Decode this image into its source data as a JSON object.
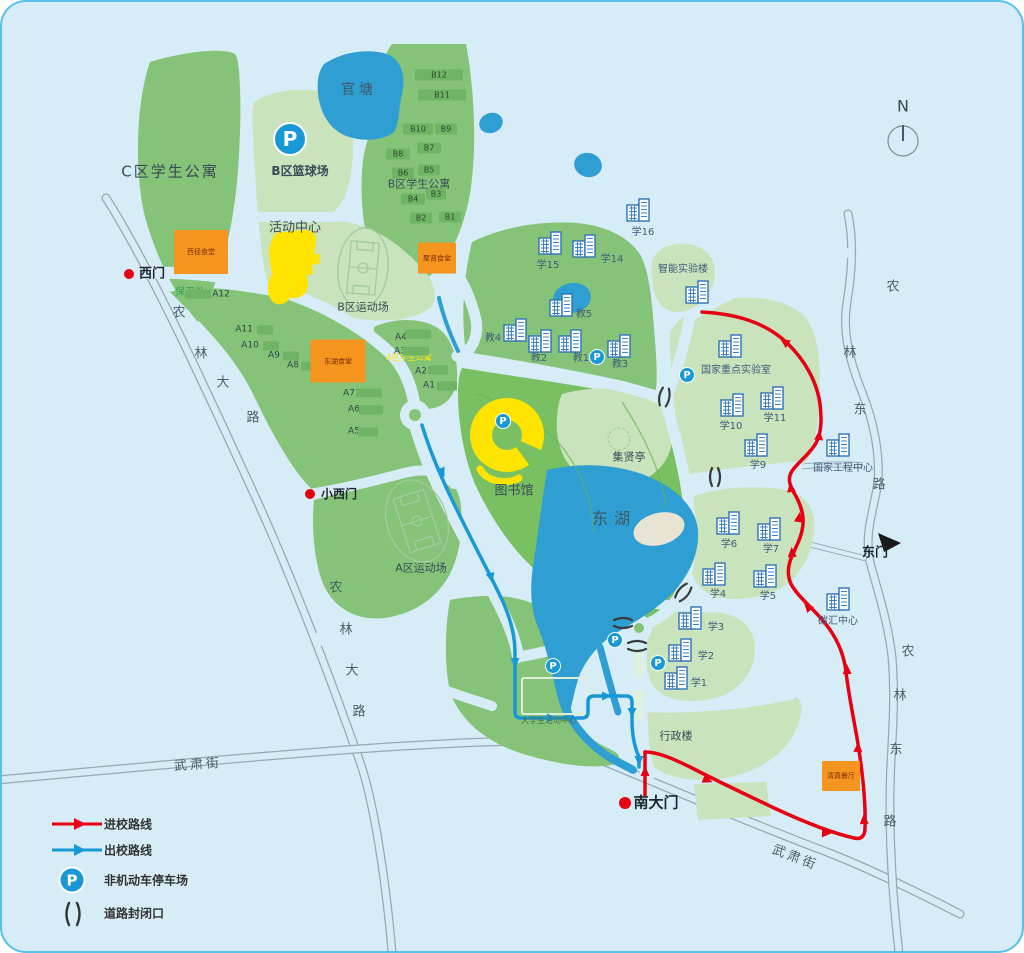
{
  "title": "校园导览图",
  "colors": {
    "background": "#d6edf7",
    "water": "#2e9ed3",
    "green_mid": "#85c478",
    "green_pale": "#c9e3bc",
    "green_park": "#79c062",
    "route_in": "#e60012",
    "route_out": "#1899d6",
    "parking_blue": "#1899d6",
    "building_icon": "#2d73b8",
    "canteen_orange": "#f5941e",
    "highlight_yellow": "#ffe400"
  },
  "icons": {
    "parking_glyph": "P"
  },
  "compass": {
    "label": "N"
  },
  "legend": {
    "items": [
      {
        "label": "进校路线"
      },
      {
        "label": "出校路线"
      },
      {
        "label": "非机动车停车场"
      },
      {
        "label": "道路封闭口"
      }
    ]
  },
  "map": {
    "area_labels": [
      {
        "name": "c-district-apartments",
        "text": "C区学生公寓",
        "x": 168,
        "y": 170,
        "size": 15,
        "ls": 2
      },
      {
        "name": "b-basketball-court",
        "text": "B区篮球场",
        "x": 298,
        "y": 169,
        "size": 12,
        "bold": true
      },
      {
        "name": "b-district-apartments",
        "text": "B区学生公寓",
        "x": 417,
        "y": 182,
        "size": 11
      },
      {
        "name": "activity-center",
        "text": "活动中心",
        "x": 293,
        "y": 226,
        "size": 13
      },
      {
        "name": "b-sports-field",
        "text": "B区运动场",
        "x": 361,
        "y": 305,
        "size": 11
      },
      {
        "name": "a-sports-field",
        "text": "A区运动场",
        "x": 419,
        "y": 566,
        "size": 11
      },
      {
        "name": "guantang-pond",
        "text": "官塘",
        "x": 357,
        "y": 88,
        "size": 14,
        "ls": 4,
        "color": "#3f5866"
      },
      {
        "name": "east-lake",
        "text": "东湖",
        "x": 612,
        "y": 517,
        "size": 16,
        "ls": 6,
        "color": "#3d5a66"
      },
      {
        "name": "library",
        "text": "图书馆",
        "x": 512,
        "y": 489,
        "size": 13
      },
      {
        "name": "jixian-pavilion",
        "text": "集贤亭",
        "x": 627,
        "y": 455,
        "size": 11
      },
      {
        "name": "security-office",
        "text": "保卫处",
        "x": 188,
        "y": 291,
        "size": 10,
        "color": "#2fa05c"
      },
      {
        "name": "a-district-apartments",
        "text": "A区学生公寓",
        "x": 407,
        "y": 356,
        "size": 8,
        "color": "#ffe400"
      },
      {
        "name": "student-activity-center",
        "text": "大学生活动中心",
        "x": 547,
        "y": 719,
        "size": 8,
        "color": "#4a6b46"
      },
      {
        "name": "admin-building",
        "text": "行政楼",
        "x": 674,
        "y": 734,
        "size": 11
      }
    ],
    "building_labels": [
      {
        "text": "学16",
        "lx": 641,
        "ly": 231,
        "ix": 637,
        "iy": 208
      },
      {
        "text": "学15",
        "lx": 546,
        "ly": 264,
        "ix": 549,
        "iy": 241
      },
      {
        "text": "学14",
        "lx": 610,
        "ly": 258,
        "ix": 583,
        "iy": 244
      },
      {
        "text": "智能实验楼",
        "lx": 681,
        "ly": 268,
        "ix": 696,
        "iy": 290
      },
      {
        "text": "教5",
        "lx": 582,
        "ly": 313,
        "ix": 560,
        "iy": 303
      },
      {
        "text": "教4",
        "lx": 491,
        "ly": 337,
        "ix": 514,
        "iy": 328
      },
      {
        "text": "教2",
        "lx": 537,
        "ly": 357,
        "ix": 539,
        "iy": 339
      },
      {
        "text": "教1",
        "lx": 579,
        "ly": 357,
        "ix": 569,
        "iy": 339
      },
      {
        "text": "教3",
        "lx": 618,
        "ly": 363,
        "ix": 618,
        "iy": 344
      },
      {
        "text": "国家重点实验室",
        "lx": 734,
        "ly": 369,
        "ix": 729,
        "iy": 344
      },
      {
        "text": "学10",
        "lx": 729,
        "ly": 425,
        "ix": 731,
        "iy": 403
      },
      {
        "text": "学11",
        "lx": 773,
        "ly": 417,
        "ix": 771,
        "iy": 396
      },
      {
        "text": "学9",
        "lx": 756,
        "ly": 464,
        "ix": 755,
        "iy": 443
      },
      {
        "text": "国家工程中心",
        "lx": 841,
        "ly": 467,
        "ix": 837,
        "iy": 443
      },
      {
        "text": "学6",
        "lx": 727,
        "ly": 543,
        "ix": 727,
        "iy": 521
      },
      {
        "text": "学7",
        "lx": 769,
        "ly": 548,
        "ix": 768,
        "iy": 527
      },
      {
        "text": "学4",
        "lx": 716,
        "ly": 593,
        "ix": 713,
        "iy": 572
      },
      {
        "text": "学5",
        "lx": 766,
        "ly": 595,
        "ix": 764,
        "iy": 574
      },
      {
        "text": "学3",
        "lx": 714,
        "ly": 626,
        "ix": 689,
        "iy": 616
      },
      {
        "text": "学2",
        "lx": 704,
        "ly": 655,
        "ix": 679,
        "iy": 648
      },
      {
        "text": "学1",
        "lx": 697,
        "ly": 682,
        "ix": 675,
        "iy": 676
      },
      {
        "text": "碳汇中心",
        "lx": 836,
        "ly": 620,
        "ix": 837,
        "iy": 597
      }
    ],
    "dorm_blocks": [
      {
        "text": "B12",
        "x": 437,
        "y": 73,
        "w": 48
      },
      {
        "text": "B11",
        "x": 440,
        "y": 93,
        "w": 48
      },
      {
        "text": "B10",
        "x": 416,
        "y": 127,
        "w": 30
      },
      {
        "text": "B9",
        "x": 444,
        "y": 127,
        "w": 22
      },
      {
        "text": "B8",
        "x": 396,
        "y": 152,
        "w": 24
      },
      {
        "text": "B7",
        "x": 427,
        "y": 146,
        "w": 24
      },
      {
        "text": "B6",
        "x": 401,
        "y": 171,
        "w": 22
      },
      {
        "text": "B5",
        "x": 427,
        "y": 168,
        "w": 22
      },
      {
        "text": "B4",
        "x": 411,
        "y": 197,
        "w": 24
      },
      {
        "text": "B3",
        "x": 434,
        "y": 192,
        "w": 20
      },
      {
        "text": "B2",
        "x": 419,
        "y": 216,
        "w": 22
      },
      {
        "text": "B1",
        "x": 448,
        "y": 215,
        "w": 22
      }
    ],
    "dorm_labels": [
      {
        "text": "A12",
        "x": 219,
        "y": 293
      },
      {
        "text": "A11",
        "x": 242,
        "y": 328
      },
      {
        "text": "A10",
        "x": 248,
        "y": 344
      },
      {
        "text": "A9",
        "x": 272,
        "y": 354
      },
      {
        "text": "A8",
        "x": 291,
        "y": 364
      },
      {
        "text": "A7",
        "x": 347,
        "y": 392
      },
      {
        "text": "A6",
        "x": 352,
        "y": 408
      },
      {
        "text": "A5",
        "x": 352,
        "y": 430
      },
      {
        "text": "A4",
        "x": 399,
        "y": 336
      },
      {
        "text": "A3",
        "x": 398,
        "y": 350
      },
      {
        "text": "A2",
        "x": 419,
        "y": 370
      },
      {
        "text": "A1",
        "x": 427,
        "y": 384
      }
    ],
    "bars": [
      [
        196,
        292,
        26
      ],
      [
        263,
        328,
        16
      ],
      [
        269,
        344,
        16
      ],
      [
        289,
        354,
        16
      ],
      [
        307,
        364,
        16
      ],
      [
        367,
        391,
        26
      ],
      [
        369,
        408,
        24
      ],
      [
        366,
        430,
        20
      ],
      [
        416,
        332,
        26
      ],
      [
        414,
        349,
        26
      ],
      [
        436,
        368,
        20
      ],
      [
        445,
        384,
        20
      ]
    ],
    "canteens": [
      {
        "text": "西径食堂",
        "x": 199,
        "y": 250,
        "w": 54,
        "h": 44
      },
      {
        "text": "东湖食堂",
        "x": 336,
        "y": 359,
        "w": 55,
        "h": 43
      },
      {
        "text": "聚贤食堂",
        "x": 435,
        "y": 256,
        "w": 38,
        "h": 31
      },
      {
        "text": "清真餐厅",
        "x": 839,
        "y": 774,
        "w": 38,
        "h": 30
      }
    ],
    "gates": [
      {
        "text": "西门",
        "x": 150,
        "y": 272,
        "dot": [
          127,
          272
        ],
        "size": 13
      },
      {
        "text": "小西门",
        "x": 337,
        "y": 492,
        "dot": [
          308,
          492
        ],
        "size": 12
      },
      {
        "text": "南大门",
        "x": 654,
        "y": 801,
        "dot": [
          623,
          801
        ],
        "size": 15
      },
      {
        "text": "东门",
        "x": 873,
        "y": 551,
        "size": 13
      }
    ],
    "road_chars": [
      {
        "text": "农",
        "x": 177,
        "y": 311
      },
      {
        "text": "林",
        "x": 199,
        "y": 352
      },
      {
        "text": "大",
        "x": 221,
        "y": 381
      },
      {
        "text": "路",
        "x": 251,
        "y": 416
      },
      {
        "text": "农",
        "x": 334,
        "y": 586
      },
      {
        "text": "林",
        "x": 344,
        "y": 628
      },
      {
        "text": "大",
        "x": 350,
        "y": 669
      },
      {
        "text": "路",
        "x": 357,
        "y": 710
      },
      {
        "text": "农",
        "x": 891,
        "y": 285
      },
      {
        "text": "林",
        "x": 848,
        "y": 351
      },
      {
        "text": "东",
        "x": 858,
        "y": 408
      },
      {
        "text": "路",
        "x": 877,
        "y": 483
      },
      {
        "text": "农",
        "x": 906,
        "y": 650
      },
      {
        "text": "林",
        "x": 898,
        "y": 694
      },
      {
        "text": "东",
        "x": 894,
        "y": 748
      },
      {
        "text": "路",
        "x": 888,
        "y": 820
      }
    ],
    "road_labels": [
      {
        "text": "武肃街",
        "x": 196,
        "y": 763,
        "rot": -4
      },
      {
        "text": "武肃街",
        "x": 793,
        "y": 856,
        "rot": 21
      }
    ],
    "parking": [
      [
        288,
        137,
        17
      ],
      [
        501,
        419,
        8
      ],
      [
        595,
        355,
        8
      ],
      [
        685,
        373,
        8
      ],
      [
        613,
        638,
        8
      ],
      [
        656,
        661,
        8
      ],
      [
        551,
        664,
        8
      ]
    ],
    "closures": [
      [
        662,
        397,
        10
      ],
      [
        713,
        477,
        0
      ],
      [
        680,
        592,
        40
      ],
      [
        619,
        621,
        90
      ],
      [
        633,
        644,
        90
      ]
    ]
  }
}
